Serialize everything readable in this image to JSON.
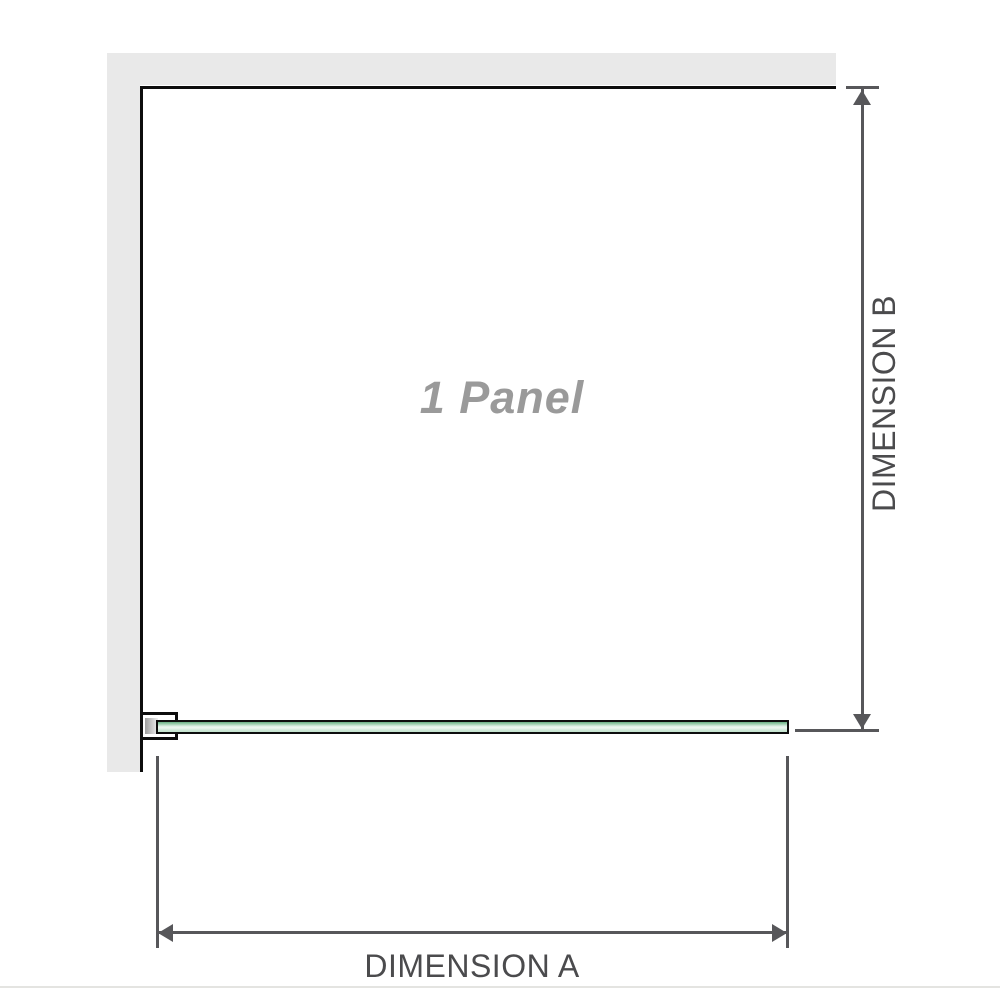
{
  "diagram": {
    "panel_label": "1 Panel",
    "dimension_a": {
      "label": "DIMENSION A"
    },
    "dimension_b": {
      "label": "DIMENSION B"
    }
  },
  "colors": {
    "wall-gray": "#e9e9e9",
    "outline-black": "#0d0d0d",
    "dim-gray": "#57575a",
    "label-gray": "#4b4b4d",
    "panel-label-gray": "#9a9a9a",
    "glass-dark": "#68ae83",
    "glass-light": "#ecf7f0",
    "glass-mid": "#c2e2cd",
    "divider-gray": "#e4e4e1"
  }
}
